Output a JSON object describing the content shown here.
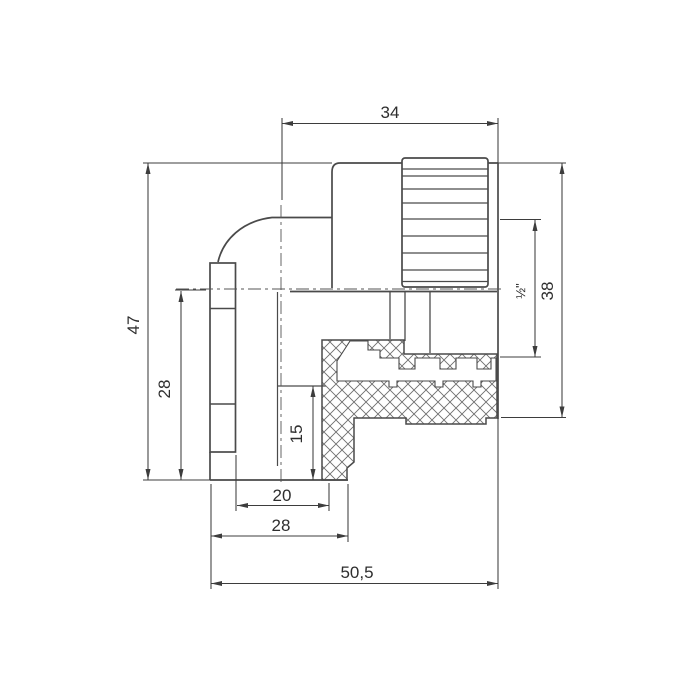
{
  "drawing": {
    "dimensions": {
      "top_width": "34",
      "overall_height": "47",
      "center_to_bottom": "28",
      "socket_depth": "15",
      "bottom_inner_width": "20",
      "bottom_width": "28",
      "overall_length": "50,5",
      "right_height": "38",
      "thread_size": "½\""
    },
    "colors": {
      "line": "#4a4a4a",
      "dimension": "#3d3d3d",
      "text": "#2e2e2e",
      "background": "#ffffff"
    }
  }
}
